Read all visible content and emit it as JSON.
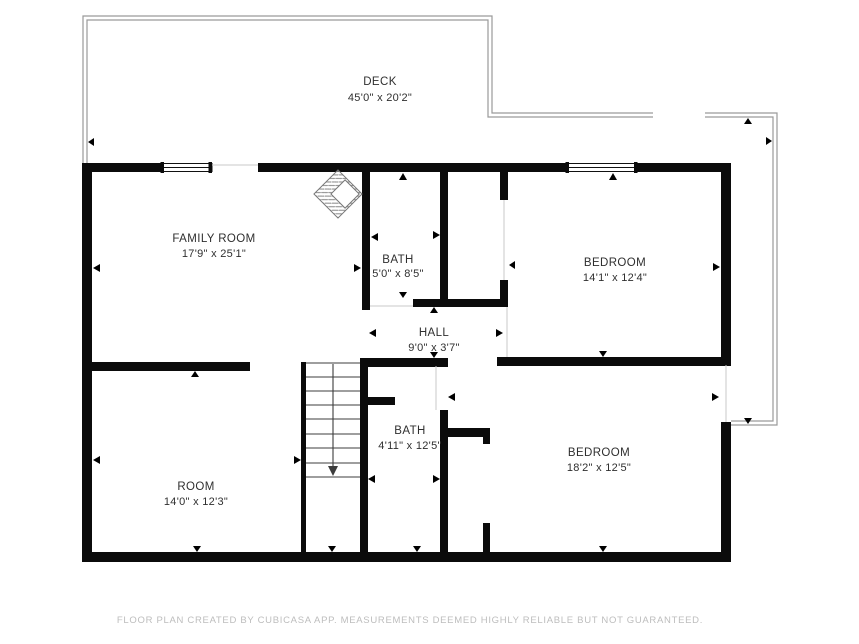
{
  "colors": {
    "background": "#ffffff",
    "wall": "#0b0b0b",
    "deck_outline": "#9a9a9a",
    "label_text": "#2f2f2f",
    "footer_text": "#bdbdbd"
  },
  "rooms": [
    {
      "name": "DECK",
      "dimensions": "45'0\" x 20'2\""
    },
    {
      "name": "FAMILY ROOM",
      "dimensions": "17'9\" x 25'1\""
    },
    {
      "name": "BATH",
      "dimensions": "5'0\" x 8'5\""
    },
    {
      "name": "BEDROOM",
      "dimensions": "14'1\" x 12'4\""
    },
    {
      "name": "HALL",
      "dimensions": "9'0\" x 3'7\""
    },
    {
      "name": "BATH",
      "dimensions": "4'11\" x 12'5\""
    },
    {
      "name": "ROOM",
      "dimensions": "14'0\" x 12'3\""
    },
    {
      "name": "BEDROOM",
      "dimensions": "18'2\" x 12'5\""
    }
  ],
  "footer": {
    "disclaimer": "FLOOR PLAN CREATED BY CUBICASA APP. MEASUREMENTS DEEMED HIGHLY RELIABLE BUT NOT GUARANTEED."
  }
}
